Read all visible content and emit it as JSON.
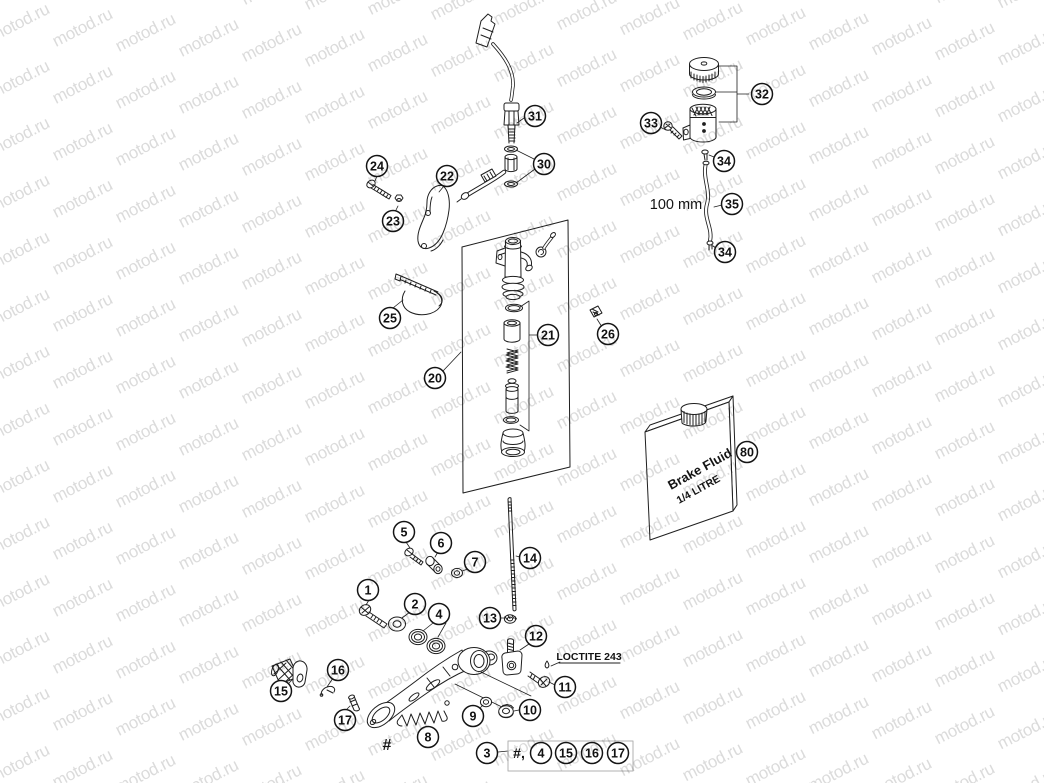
{
  "watermark": {
    "text": "motod.ru",
    "color": "#d9d9d9"
  },
  "annotations": {
    "hose_length": "100 mm",
    "loctite_note": "LOCTITE 243",
    "pedal_ref": "#",
    "footnote_prefix": "#,"
  },
  "bottle": {
    "line1": "Brake Fluid",
    "line2": "1/4 LITRE"
  },
  "labels": [
    {
      "name": "hose-length-label",
      "text": "100 mm",
      "x": 676,
      "y": 209,
      "size": 14.5,
      "bold": false,
      "rotate": 0,
      "anchor": "middle"
    },
    {
      "name": "loctite-label",
      "text": "LOCTITE 243",
      "x": 589,
      "y": 660,
      "size": 10.5,
      "bold": true,
      "rotate": 0,
      "anchor": "middle"
    },
    {
      "name": "pedal-hash-label",
      "text": "#",
      "x": 387,
      "y": 750,
      "size": 16,
      "bold": true,
      "rotate": 0,
      "anchor": "middle"
    },
    {
      "name": "footnote-prefix",
      "text": "#,",
      "x": 519,
      "y": 758,
      "size": 14,
      "bold": true,
      "rotate": 0,
      "anchor": "middle"
    },
    {
      "name": "bottle-label-line1",
      "text": "Brake Fluid",
      "x": 671,
      "y": 490,
      "size": 13,
      "bold": true,
      "rotate": -29,
      "anchor": "start"
    },
    {
      "name": "bottle-label-line2",
      "text": "1/4 LITRE",
      "x": 679,
      "y": 504,
      "size": 10.5,
      "bold": true,
      "rotate": -29,
      "anchor": "start"
    }
  ],
  "callouts": [
    {
      "label": "31",
      "x": 535,
      "y": 116
    },
    {
      "label": "30",
      "x": 544,
      "y": 164
    },
    {
      "label": "22",
      "x": 447,
      "y": 176
    },
    {
      "label": "24",
      "x": 377,
      "y": 166
    },
    {
      "label": "23",
      "x": 393,
      "y": 221
    },
    {
      "label": "25",
      "x": 390,
      "y": 318
    },
    {
      "label": "20",
      "x": 435,
      "y": 378
    },
    {
      "label": "21",
      "x": 548,
      "y": 335
    },
    {
      "label": "26",
      "x": 608,
      "y": 334
    },
    {
      "label": "32",
      "x": 762,
      "y": 94
    },
    {
      "label": "33",
      "x": 651,
      "y": 123
    },
    {
      "label": "34",
      "x": 724,
      "y": 161
    },
    {
      "label": "35",
      "x": 732,
      "y": 204
    },
    {
      "label": "34",
      "x": 725,
      "y": 252
    },
    {
      "label": "80",
      "x": 747,
      "y": 452
    },
    {
      "label": "14",
      "x": 530,
      "y": 558
    },
    {
      "label": "5",
      "x": 404,
      "y": 532
    },
    {
      "label": "6",
      "x": 441,
      "y": 543
    },
    {
      "label": "7",
      "x": 475,
      "y": 562
    },
    {
      "label": "1",
      "x": 368,
      "y": 590
    },
    {
      "label": "2",
      "x": 415,
      "y": 604
    },
    {
      "label": "4",
      "x": 439,
      "y": 614
    },
    {
      "label": "13",
      "x": 490,
      "y": 618
    },
    {
      "label": "12",
      "x": 536,
      "y": 636
    },
    {
      "label": "16",
      "x": 338,
      "y": 670
    },
    {
      "label": "15",
      "x": 281,
      "y": 691
    },
    {
      "label": "17",
      "x": 345,
      "y": 720
    },
    {
      "label": "8",
      "x": 428,
      "y": 737
    },
    {
      "label": "9",
      "x": 473,
      "y": 716
    },
    {
      "label": "10",
      "x": 530,
      "y": 710
    },
    {
      "label": "11",
      "x": 565,
      "y": 687
    },
    {
      "label": "3",
      "x": 487,
      "y": 753
    },
    {
      "label": "4",
      "x": 541,
      "y": 753
    },
    {
      "label": "15",
      "x": 566,
      "y": 753
    },
    {
      "label": "16",
      "x": 592,
      "y": 753
    },
    {
      "label": "17",
      "x": 618,
      "y": 753
    }
  ]
}
